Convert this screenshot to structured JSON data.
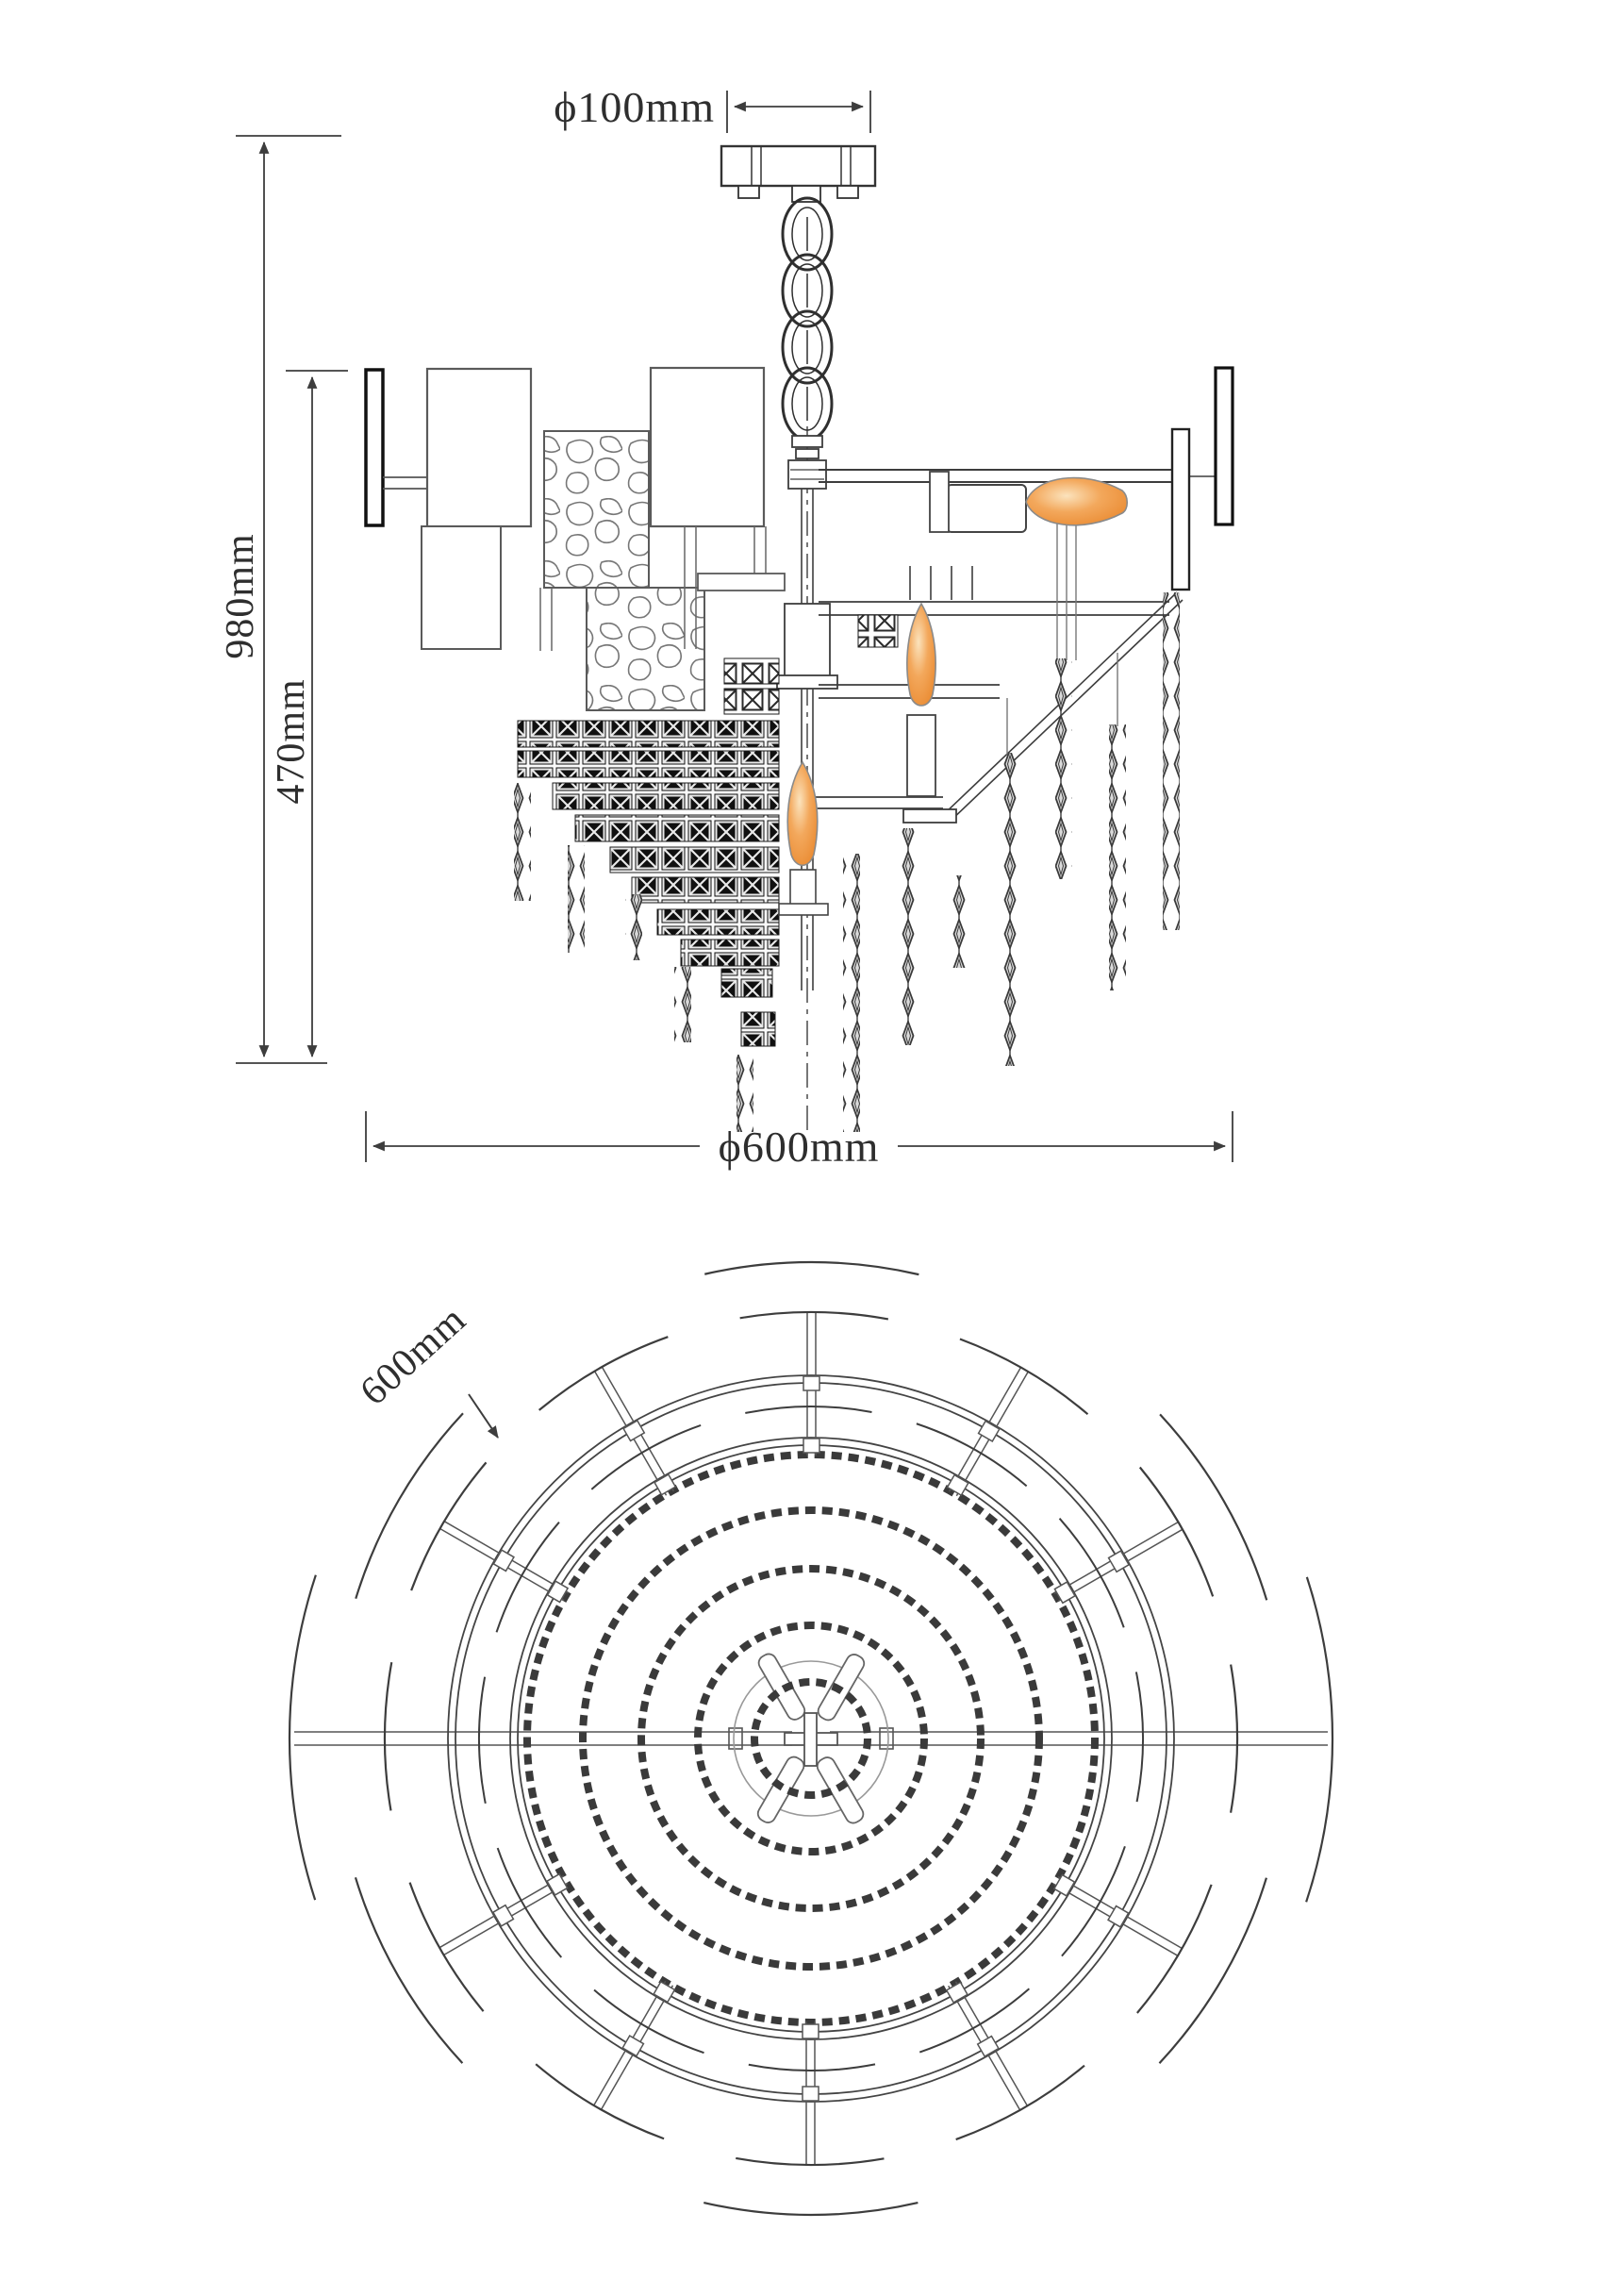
{
  "drawing": {
    "side_view": {
      "dim_mount_diameter": "ϕ100mm",
      "dim_total_height": "980mm",
      "dim_body_height": "470mm",
      "dim_body_diameter": "ϕ600mm"
    },
    "plan_view": {
      "dim_diameter": "600mm"
    },
    "colors": {
      "line": "#3d3d3d",
      "flame_core": "#fbe3bd",
      "flame_mid": "#f3a85c",
      "flame_edge": "#e9882e"
    }
  }
}
